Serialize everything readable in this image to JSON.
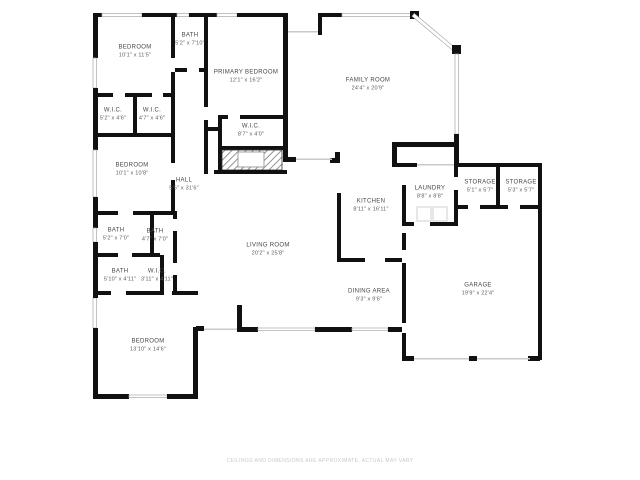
{
  "floor_plan": {
    "watermark": "CEILINGS AND DIMENSIONS ARE APPROXIMATE, ACTUAL MAY VARY",
    "colors": {
      "wall": "#111111",
      "window_line": "#a8a8a8",
      "label_text": "#474747",
      "watermark_text": "#c8c8c8",
      "background": "#ffffff"
    },
    "rooms": [
      {
        "name": "BEDROOM",
        "dims": "10'1\" x 11'5\"",
        "x": 135,
        "y": 52
      },
      {
        "name": "BATH",
        "dims": "5'2\" x 7'10\"",
        "x": 190,
        "y": 40
      },
      {
        "name": "PRIMARY BEDROOM",
        "dims": "12'1\" x 16'2\"",
        "x": 246,
        "y": 77
      },
      {
        "name": "FAMILY ROOM",
        "dims": "24'4\" x 20'9\"",
        "x": 368,
        "y": 85
      },
      {
        "name": "W.I.C.",
        "dims": "5'2\" x 4'6\"",
        "x": 113,
        "y": 115
      },
      {
        "name": "W.I.C.",
        "dims": "4'7\" x 4'6\"",
        "x": 152,
        "y": 115
      },
      {
        "name": "W.I.C.",
        "dims": "8'7\" x 4'0\"",
        "x": 251,
        "y": 131
      },
      {
        "name": "BEDROOM",
        "dims": "10'1\" x 10'8\"",
        "x": 132,
        "y": 170
      },
      {
        "name": "HALL",
        "dims": "5'5\" x 31'6\"",
        "x": 184,
        "y": 185
      },
      {
        "name": "LAUNDRY",
        "dims": "8'8\" x 8'8\"",
        "x": 430,
        "y": 193
      },
      {
        "name": "STORAGE",
        "dims": "5'1\" x 5'7\"",
        "x": 480,
        "y": 187
      },
      {
        "name": "STORAGE",
        "dims": "5'3\" x 5'7\"",
        "x": 521,
        "y": 187
      },
      {
        "name": "KITCHEN",
        "dims": "8'11\" x 16'11\"",
        "x": 371,
        "y": 206
      },
      {
        "name": "BATH",
        "dims": "5'2\" x 7'0\"",
        "x": 116,
        "y": 235
      },
      {
        "name": "BATH",
        "dims": "4'7\" x 7'0\"",
        "x": 155,
        "y": 236
      },
      {
        "name": "LIVING ROOM",
        "dims": "20'2\" x 25'8\"",
        "x": 268,
        "y": 250
      },
      {
        "name": "BATH",
        "dims": "5'10\" x 4'11\"",
        "x": 120,
        "y": 276
      },
      {
        "name": "W.I.C.",
        "dims": "3'11\" x 4'11\"",
        "x": 157,
        "y": 276
      },
      {
        "name": "GARAGE",
        "dims": "19'9\" x 22'4\"",
        "x": 478,
        "y": 290
      },
      {
        "name": "DINING AREA",
        "dims": "9'3\" x 9'6\"",
        "x": 369,
        "y": 296
      },
      {
        "name": "BEDROOM",
        "dims": "13'10\" x 14'6\"",
        "x": 148,
        "y": 346
      }
    ]
  }
}
